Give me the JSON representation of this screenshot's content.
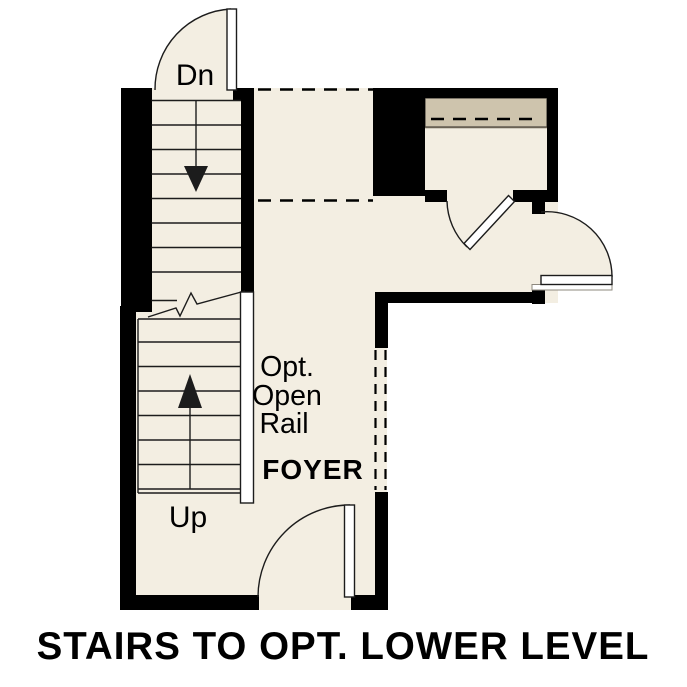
{
  "caption": "STAIRS TO OPT. LOWER LEVEL",
  "labels": {
    "stairs_down": "Dn",
    "stairs_up": "Up",
    "room": "FOYER",
    "rail_note_line1": "Opt.",
    "rail_note_line2": "Open",
    "rail_note_line3": "Rail"
  },
  "colors": {
    "floor": "#f3eee2",
    "shelf": "#cec4ad",
    "wall": "#000000",
    "line": "#1c1c1c",
    "background": "#ffffff",
    "text": "#000000"
  }
}
